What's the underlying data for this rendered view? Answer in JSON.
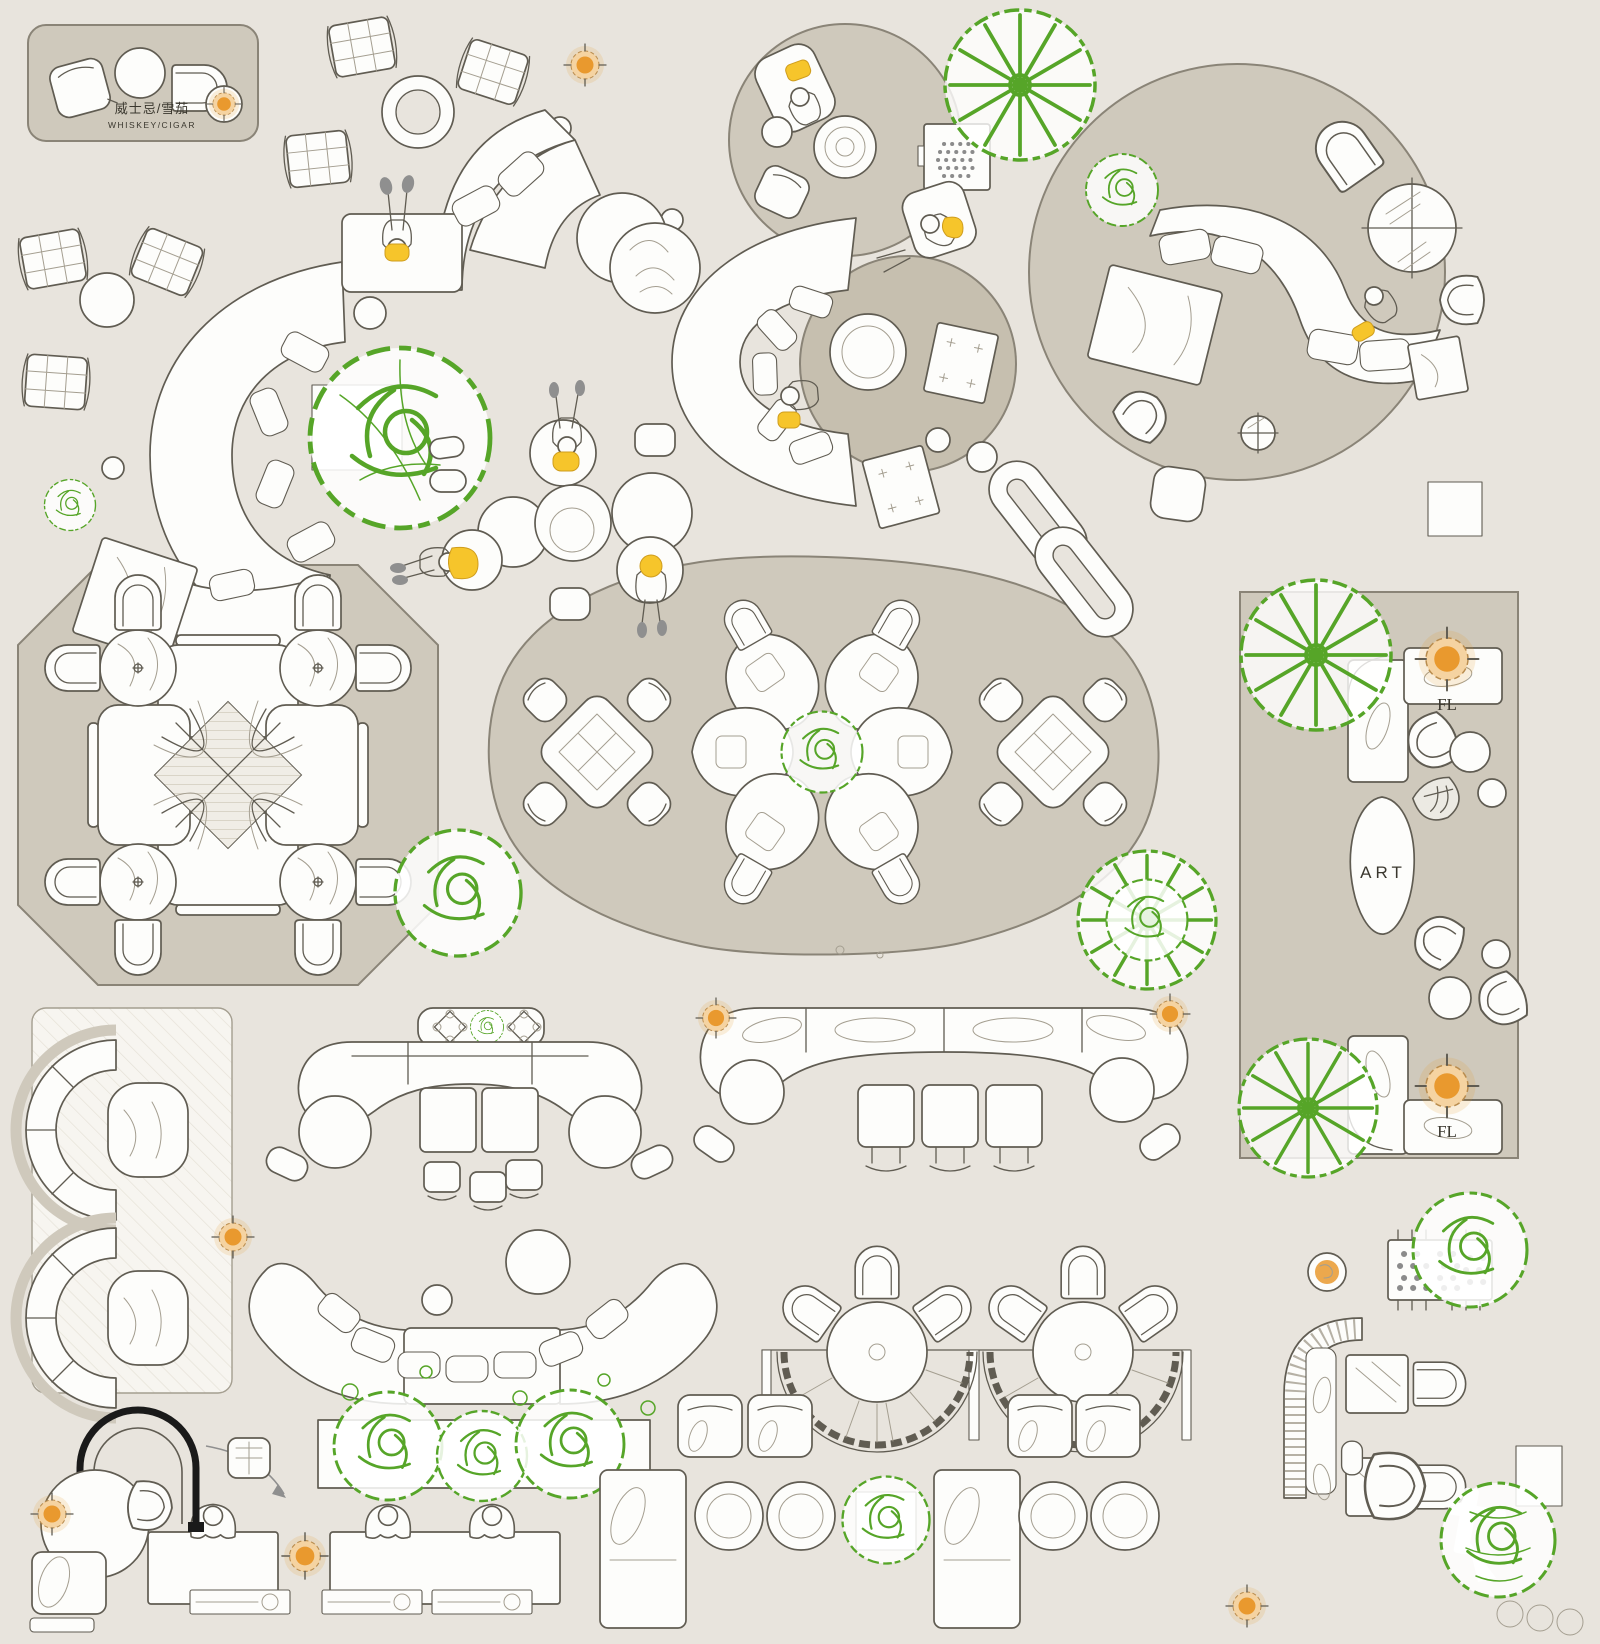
{
  "meta": {
    "type": "interior-furniture-floor-plan-top-view",
    "canvas": {
      "width": 1600,
      "height": 1644
    }
  },
  "palette": {
    "background": "#e8e4dd",
    "rug": "#cfc9bc",
    "rug_dark": "#c6bfaf",
    "rug_line": "#8a8477",
    "panel": "#f6f4ee",
    "line": "#605c52",
    "line_light": "#a49e90",
    "white": "#fdfdfb",
    "green": "#56a528",
    "orange": "#e9992e",
    "orange_light": "#f5d3a1",
    "yellow": "#f6c52b",
    "gray": "#8f8f8f",
    "black": "#1a1a1a",
    "text": "#3a372e"
  },
  "labels": {
    "whiskey_zone_cn": "威士忌/雪茄",
    "whiskey_zone_en": "WHISKEY/CIGAR",
    "art_sculpture": "ART",
    "floor_lamp_top": "FL",
    "floor_lamp_bottom": "FL"
  },
  "zones": [
    {
      "id": "whiskey-cigar-lounge",
      "items": [
        "lounge-chair",
        "round-table",
        "armchair",
        "side-table",
        "cocktail-lamp"
      ]
    },
    {
      "id": "serpentine-sofa-lounge",
      "items": [
        "curved-sofa",
        "daybed-with-person",
        "square-table",
        "quilted-ottomans",
        "planter-tree",
        "donut-table"
      ]
    },
    {
      "id": "round-rug-media-corner",
      "items": [
        "chaise-with-person",
        "coffee-table",
        "stool",
        "armchair",
        "speaker-cabinet"
      ]
    },
    {
      "id": "crescent-sofa-on-round-rug",
      "items": [
        "crescent-sofa-with-person",
        "coffee-table",
        "speaker-cabinets"
      ]
    },
    {
      "id": "large-circle-lounge",
      "items": [
        "s-curve-sofa-with-person",
        "marble-end-tables",
        "glass-round-tables",
        "armchair",
        "pod-chairs",
        "pouf",
        "trees"
      ]
    },
    {
      "id": "ball-chair",
      "items": [
        "sphere-chair"
      ]
    },
    {
      "id": "beanbag-cluster",
      "items": [
        "pebble-poufs",
        "three-people-with-laptops",
        "mini-ottomans"
      ]
    },
    {
      "id": "chain-sculpture",
      "items": [
        "two-interlocked-links"
      ]
    },
    {
      "id": "octagon-dining-pod",
      "items": [
        "clover-booth",
        "four-round-tables",
        "eight-armchairs"
      ]
    },
    {
      "id": "organic-blob-lounge",
      "items": [
        "two-lattice-tables",
        "eight-blob-chairs",
        "petal-booth-ring",
        "center-plant",
        "four-small-chairs"
      ]
    },
    {
      "id": "right-gallery-rug",
      "items": [
        "two-l-sofas",
        "pod-chairs",
        "round-tables",
        "art-sculpture",
        "two-floor-lamps",
        "two-trees"
      ]
    },
    {
      "id": "left-booth-panel",
      "items": [
        "two-semicircle-booths",
        "capsule-tables"
      ]
    },
    {
      "id": "bar-counter-left",
      "items": [
        "bow-counter",
        "shelf-with-plant",
        "square-tables",
        "round-tables",
        "stools"
      ]
    },
    {
      "id": "bar-counter-right",
      "items": [
        "bow-counter",
        "cushion-seats",
        "two-counter-lamps",
        "round-stools",
        "square-stools"
      ]
    },
    {
      "id": "u-sofa-lounge",
      "items": [
        "u-shaped-sofa",
        "coffee-tables",
        "planter-box",
        "floor-lamp"
      ]
    },
    {
      "id": "fan-booth-pair",
      "items": [
        "two-scalloped-benches",
        "two-round-tables",
        "six-chairs"
      ]
    },
    {
      "id": "games-corner",
      "items": [
        "perforated-game-table",
        "cocktail-tray",
        "ribbed-banquette",
        "two-square-tables",
        "two-chairs",
        "shrub"
      ]
    },
    {
      "id": "work-desk-row",
      "items": [
        "two-desks",
        "three-people",
        "drawer-consoles",
        "desk-lamp"
      ]
    },
    {
      "id": "reading-corner",
      "items": [
        "black-arch-chair",
        "arrow-note",
        "round-table-with-lamp",
        "tub-chair",
        "lounge-chair-with-pillow"
      ]
    },
    {
      "id": "bottom-seating-strip",
      "items": [
        "leaf-pillow-loungers",
        "round-side-tables",
        "plant-ball",
        "quilted-chairs"
      ]
    },
    {
      "id": "watermark-plant-corner",
      "items": [
        "fern-plant",
        "logo-watermark",
        "console",
        "stool-circles",
        "floor-lamp"
      ]
    }
  ]
}
